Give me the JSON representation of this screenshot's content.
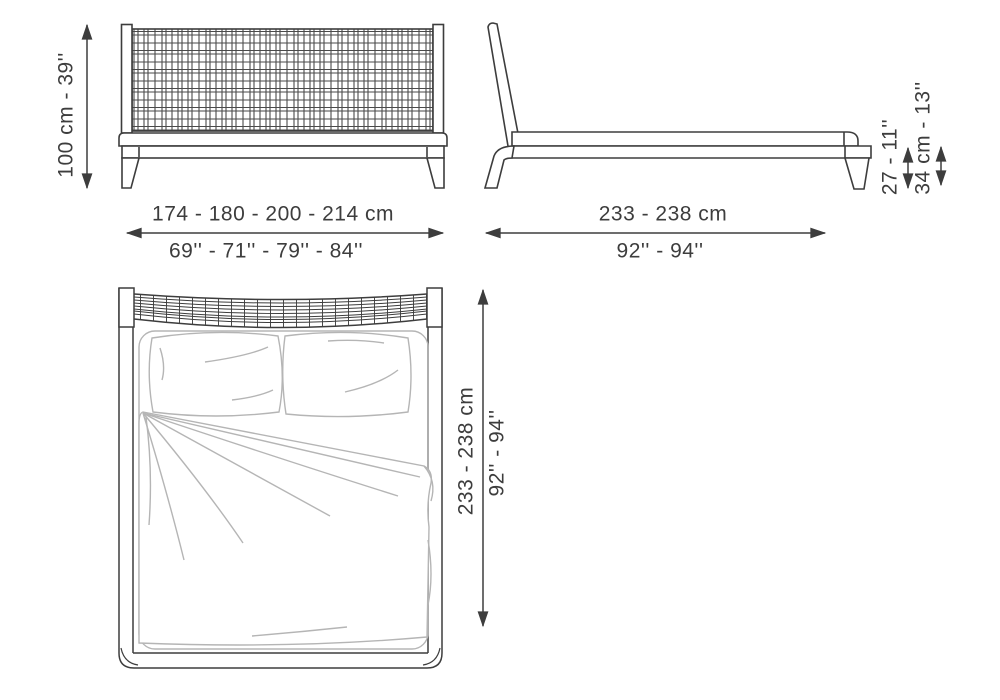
{
  "drawing_title": "bed-dimension-diagram",
  "colors": {
    "ink": "#3d3d3d",
    "soft_sketch": "#b5b5b5",
    "background": "#ffffff"
  },
  "views": {
    "front": {
      "name": "front-view",
      "height_label": "100 cm - 39''",
      "width_label_cm": "174 - 180 - 200 - 214 cm",
      "width_label_in": "69'' - 71'' - 79'' - 84''"
    },
    "side": {
      "name": "side-view",
      "length_label_cm": "233 - 238 cm",
      "length_label_in": "92'' - 94''",
      "rail_height_label": "27 - 11''",
      "platform_height_label": "34 cm - 13''"
    },
    "top": {
      "name": "top-view",
      "length_label_cm": "233 - 238 cm",
      "length_label_in": "92'' - 94''"
    }
  }
}
